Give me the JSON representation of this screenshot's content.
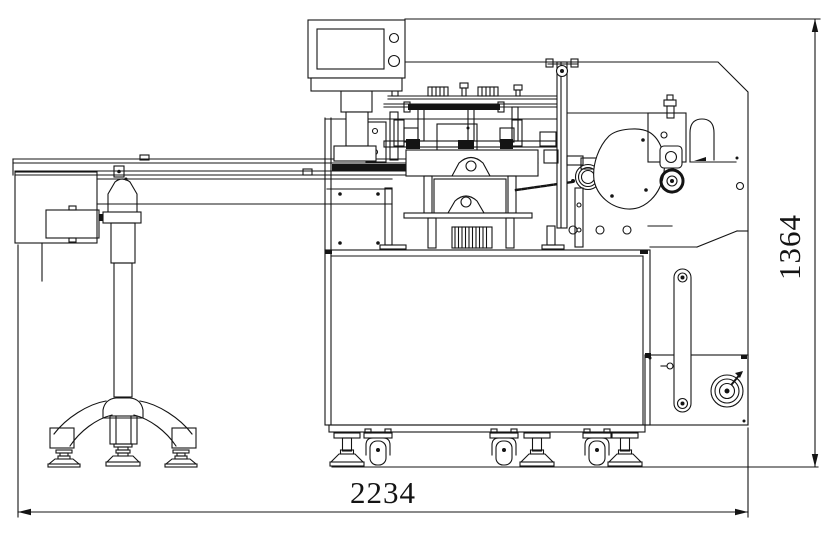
{
  "drawing": {
    "labels": {
      "overall_length": "2234",
      "overall_height": "1364"
    },
    "colors": {
      "line": "#141414",
      "background": "#ffffff"
    },
    "components": [
      "hmi-panel",
      "hmi-screen",
      "infeed-conveyor",
      "electrical-box",
      "conveyor-stand",
      "wrapping-mechanism",
      "film-guide-pole",
      "cam-cover",
      "adjust-knob",
      "machine-cabinet",
      "side-drive-belt",
      "handwheel",
      "leveling-feet",
      "casters",
      "dimension-annotations"
    ]
  }
}
